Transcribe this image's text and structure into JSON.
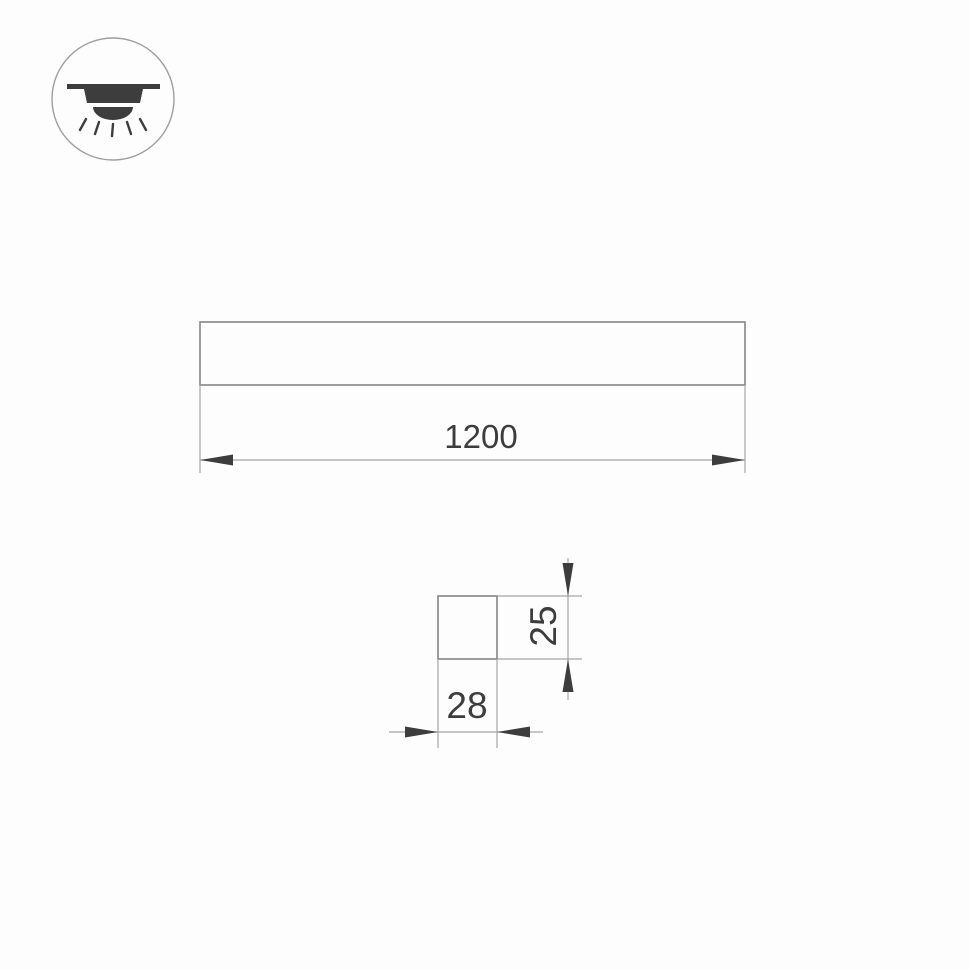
{
  "drawing": {
    "background_color": "#fdfdfd",
    "outline_color": "#8c8c8c",
    "dimension_line_color": "#a6a6a6",
    "arrow_and_text_color": "#3d3d3d",
    "icon": {
      "name": "recessed-ceiling-light-icon",
      "description": "circled pictogram of a ceiling-mounted light shining downward"
    },
    "side_view": {
      "length_label": "1200"
    },
    "cross_section": {
      "width_label": "28",
      "height_label": "25"
    }
  }
}
